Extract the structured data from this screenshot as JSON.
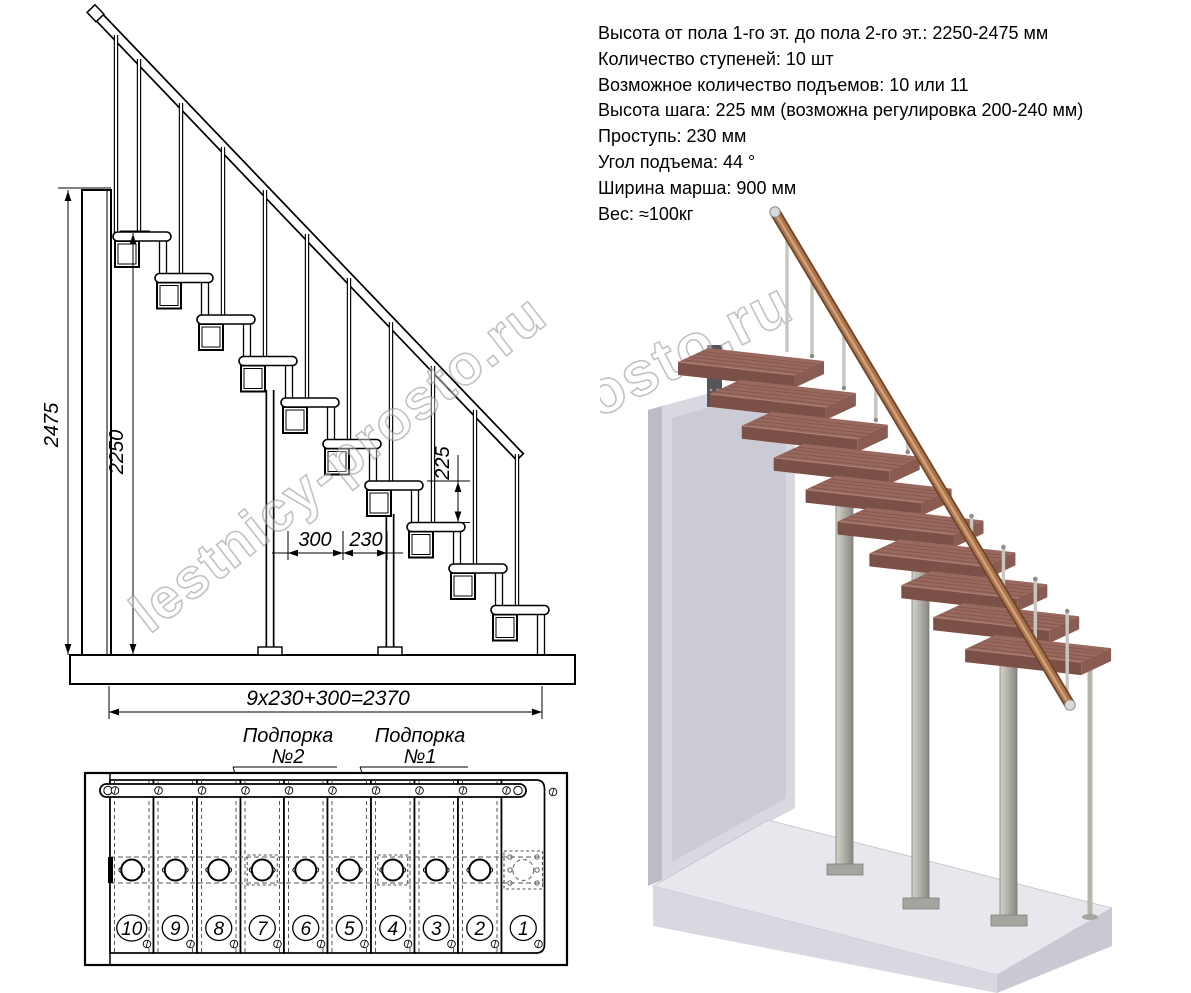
{
  "specs": {
    "lines": [
      "Высота от пола 1-го эт. до пола 2-го эт.: 2250-2475 мм",
      "Количество ступеней: 10 шт",
      "Возможное количество подъемов: 10 или 11",
      "Высота шага: 225 мм (возможна регулировка 200-240 мм)",
      "Проступь: 230 мм",
      "Угол подъема: 44 °",
      "Ширина марша: 900 мм",
      "Вес: ≈100кг"
    ]
  },
  "side_view": {
    "dim_floor_to_floor": "2475",
    "dim_stair_height": "2250",
    "dim_run_300": "300",
    "dim_run_230": "230",
    "dim_rise": "225",
    "dim_total_run": "9x230+300=2370"
  },
  "plan_view": {
    "support_2": {
      "line1": "Подпорка",
      "line2": "№2"
    },
    "support_1": {
      "line1": "Подпорка",
      "line2": "№1"
    },
    "step_numbers": [
      "10",
      "9",
      "8",
      "7",
      "6",
      "5",
      "4",
      "3",
      "2",
      "1"
    ]
  },
  "watermark": {
    "text": "lestnicy-prosto.ru"
  },
  "colors": {
    "tread_top": "#9a695e",
    "tread_front": "#7b5046",
    "tread_side": "#8a5c51",
    "handrail": "#a9744e",
    "metal": "#b3b2ab",
    "wall": "#d8d8e0",
    "wall_side": "#bcbcc6",
    "floor": "#e7e7ee",
    "line": "#000000"
  }
}
